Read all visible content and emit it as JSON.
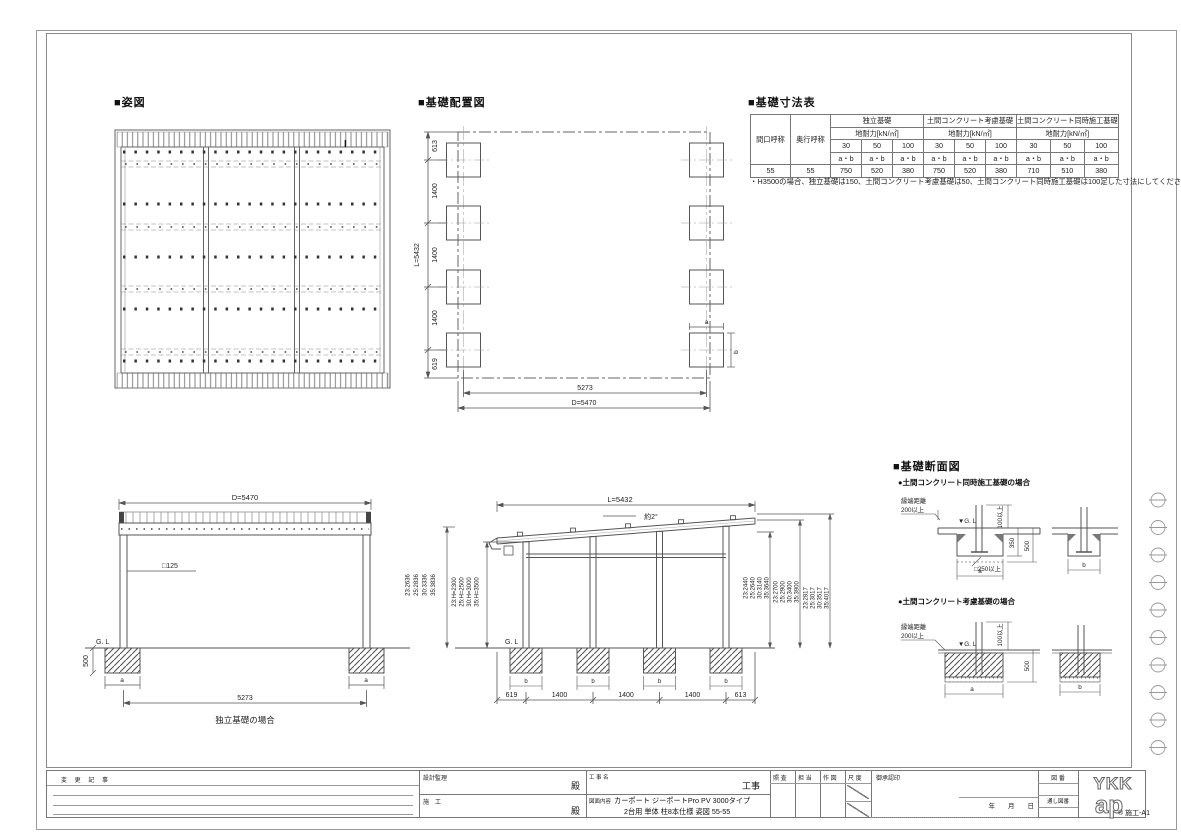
{
  "titles": {
    "plan": "■姿図",
    "layout": "■基礎配置図",
    "dim_table": "■基礎寸法表",
    "section": "■基礎断面図"
  },
  "plan": {
    "mark": "I"
  },
  "table": {
    "row_headers": [
      "間口呼称",
      "奥行呼称"
    ],
    "groups": [
      "独立基礎",
      "土間コンクリート考慮基礎",
      "土間コンクリート同時施工基礎"
    ],
    "subheader": "地耐力[kN/㎡]",
    "capacities": [
      "30",
      "50",
      "100"
    ],
    "ab": "a・b",
    "data_row": [
      "55",
      "55",
      "750",
      "520",
      "380",
      "750",
      "520",
      "380",
      "710",
      "510",
      "380"
    ],
    "note": "・H3500の場合、独立基礎は150、土間コンクリート考慮基礎は50、土間コンクリート同時施工基礎は100足した寸法にしてください。"
  },
  "layout_fig": {
    "dims_v": [
      "613",
      "1400",
      "1400",
      "1400",
      "619"
    ],
    "total_v": "L=5432",
    "span": "5273",
    "total_h": "D=5470",
    "a": "a",
    "b": "b"
  },
  "front_elev": {
    "total": "D=5470",
    "post": "□125",
    "gl": "G. L",
    "depth": "500",
    "a": "a",
    "span": "5273",
    "caption": "独立基礎の場合"
  },
  "side_elev": {
    "total": "L=5432",
    "slope": "約2°",
    "gl": "G. L",
    "h_outer": [
      "23:2636",
      "25:2836",
      "30:3336",
      "35:3836"
    ],
    "h_inner": [
      "23:H=2300",
      "25:H=2500",
      "30:H=3000",
      "35:H=3500"
    ],
    "r1": [
      "23:2440",
      "25:2640",
      "30:3140",
      "35:3640"
    ],
    "r2": [
      "23:2700",
      "25:2900",
      "30:3400",
      "35:3900"
    ],
    "r3": [
      "23:2817",
      "25:3017",
      "30:3517",
      "35:4017"
    ],
    "dims_bottom": [
      "619",
      "1400",
      "1400",
      "1400",
      "613"
    ],
    "b": "b"
  },
  "sections": {
    "s1_title": "●土間コンクリート同時施工基礎の場合",
    "s2_title": "●土間コンクリート考慮基礎の場合",
    "edge1": "縁端距離",
    "edge2": "200以上",
    "gl": "▼G. L",
    "min100": "100以上",
    "d350": "350",
    "d500": "500",
    "min250": "□250以上",
    "a": "a",
    "b": "b"
  },
  "titleblock": {
    "change_label": "変 更 記 事",
    "design_label": "設計監理",
    "dono1": "殿",
    "construct_label": "施　工",
    "dono2": "殿",
    "kojimei_label": "工 事 名",
    "koji": "工事",
    "zumen_label": "図面内容",
    "content_line1": "カーポート ジーポートPro PV 3000タイプ",
    "content_line2": "2台用 単体 柱8本仕様 姿図 55-55",
    "check": "照 査",
    "charge": "担 当",
    "draw": "作 図",
    "scale": "尺 度",
    "approval": "御承認印",
    "date": "年　　月　　日",
    "zuban": "図 番",
    "tooshi": "通し図番",
    "logo1": "YKK",
    "logo2": "ap",
    "sheet": "® 施工-A1"
  }
}
